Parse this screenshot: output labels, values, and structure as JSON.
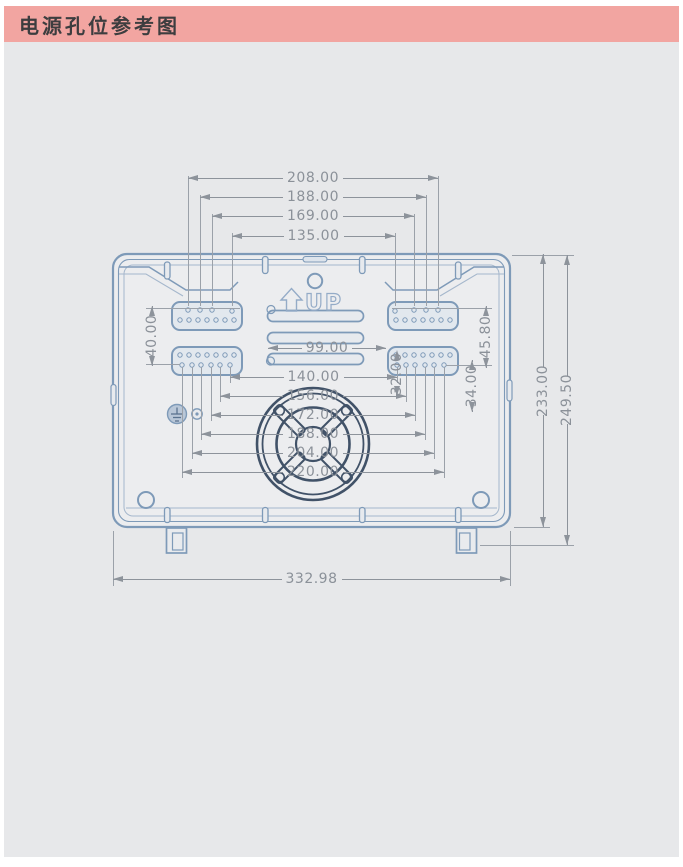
{
  "header": {
    "title": "电源孔位参考图"
  },
  "drawing": {
    "up_label": "UP",
    "dims": {
      "top": [
        "208.00",
        "188.00",
        "169.00",
        "135.00"
      ],
      "middle": [
        "99.00",
        "140.00"
      ],
      "fan": [
        "156.00",
        "172.00",
        "188.00",
        "204.00",
        "220.00"
      ],
      "bottom": [
        "332.98"
      ],
      "left": [
        "40.00"
      ],
      "right_inner": [
        "45.80",
        "32.00",
        "34.00"
      ],
      "right_outer": [
        "233.00",
        "249.50"
      ]
    }
  }
}
